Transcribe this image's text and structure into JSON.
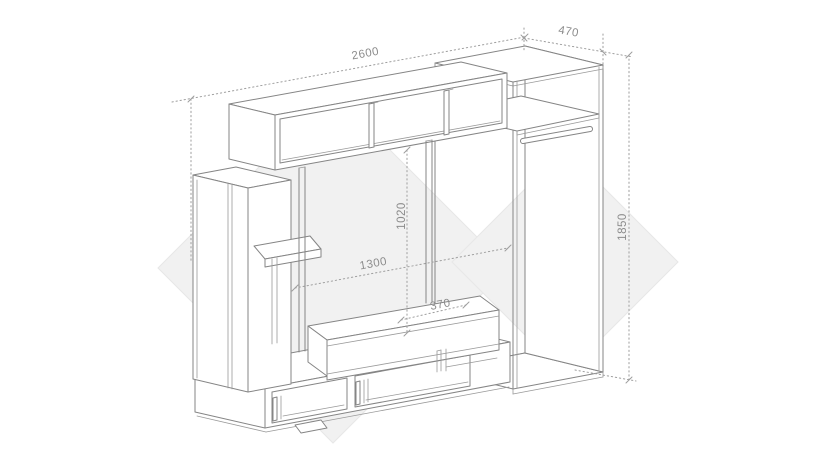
{
  "dims": {
    "total_width": "2600",
    "wardrobe_depth": "470",
    "niche_height": "1020",
    "niche_width": "1300",
    "bench_depth": "370",
    "wardrobe_height": "1850"
  },
  "colors": {
    "background": "#ffffff",
    "line": "#858585",
    "dimension_line": "#9e9e9e",
    "label_text": "#8c8c8c",
    "watermark": "#f1f1f1"
  }
}
